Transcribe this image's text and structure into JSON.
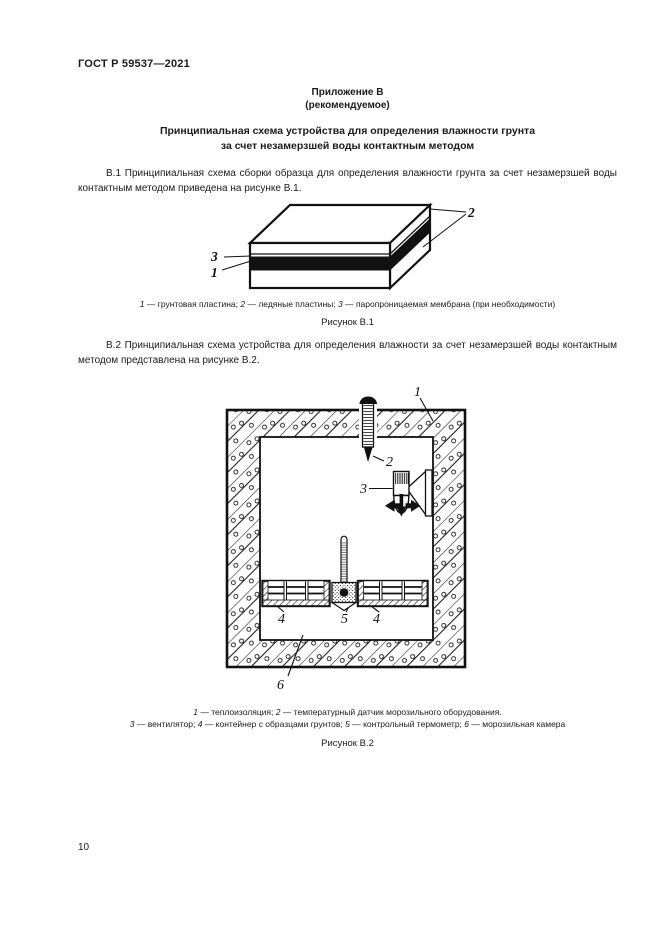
{
  "header": {
    "doc_code": "ГОСТ Р 59537—2021"
  },
  "annex": {
    "label": "Приложение В",
    "note": "(рекомендуемое)"
  },
  "title": {
    "line1": "Принципиальная схема устройства для определения влажности грунта",
    "line2": "за счет незамерзшей воды контактным методом"
  },
  "paragraphs": {
    "b1": "В.1 Принципиальная схема сборки образца для определения влажности грунта за счет незамерзшей воды контактным методом приведена на рисунке В.1.",
    "b2": "В.2 Принципиальная схема устройства для определения влажности за счет незамерзшей воды контактным методом представлена на рисунке В.2."
  },
  "figure1": {
    "title": "Рисунок В.1",
    "labels": {
      "l1": "1",
      "l2": "2",
      "l3": "3"
    },
    "caption_segments": [
      {
        "t": "1",
        "i": 1
      },
      {
        "t": " — грунтовая пластина; ",
        "i": 0
      },
      {
        "t": "2",
        "i": 1
      },
      {
        "t": " — ледяные пластины; ",
        "i": 0
      },
      {
        "t": "3",
        "i": 1
      },
      {
        "t": " — паропроницаемая мембрана (при необходимости)",
        "i": 0
      }
    ]
  },
  "figure2": {
    "title": "Рисунок В.2",
    "labels": {
      "l1": "1",
      "l2": "2",
      "l3": "3",
      "l4a": "4",
      "l5": "5",
      "l4b": "4",
      "l6": "6"
    },
    "caption_line1_segments": [
      {
        "t": "1",
        "i": 1
      },
      {
        "t": " — теплоизоляция; ",
        "i": 0
      },
      {
        "t": "2",
        "i": 1
      },
      {
        "t": " — температурный датчик морозильного оборудования.",
        "i": 0
      }
    ],
    "caption_line2_segments": [
      {
        "t": "3",
        "i": 1
      },
      {
        "t": " — вентилятор; ",
        "i": 0
      },
      {
        "t": "4",
        "i": 1
      },
      {
        "t": " — контейнер с образцами грунтов; ",
        "i": 0
      },
      {
        "t": "5",
        "i": 1
      },
      {
        "t": " — контрольный термометр; ",
        "i": 0
      },
      {
        "t": "6",
        "i": 1
      },
      {
        "t": " — морозильная камера",
        "i": 0
      }
    ]
  },
  "page": {
    "number": "10"
  },
  "colors": {
    "ink": "#1b1b1b",
    "paper": "#ffffff"
  }
}
